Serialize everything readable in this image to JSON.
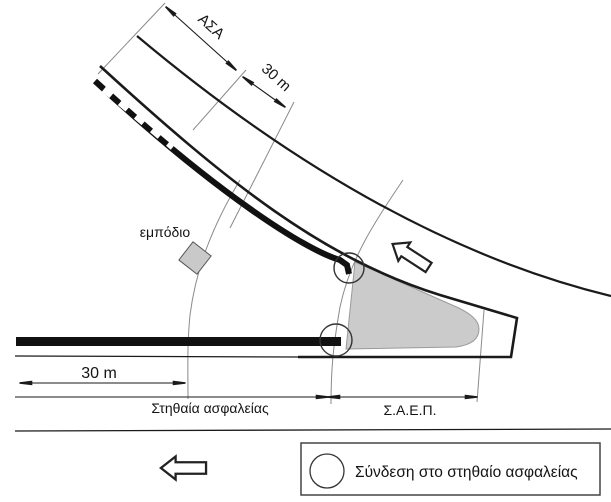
{
  "figure": {
    "labels": {
      "asa": "ΑΣΑ",
      "dist_top": "30 m",
      "obstacle": "εμπόδιο",
      "dist_bottom": "30 m",
      "barrier_span": "Στηθαία ασφαλείας",
      "saep_span": "Σ.Α.Ε.Π."
    },
    "legend": {
      "symbol": "connection-circle",
      "text": "Σύνδεση στο στηθαίο ασφαλείας"
    },
    "icons": {
      "direction_arrow": "hollow-left-block-arrow",
      "connection": "open-circle"
    },
    "colors": {
      "line": "#1a1a1a",
      "construction": "#888888",
      "island_fill": "#cbcbcb",
      "background": "#ffffff"
    }
  }
}
